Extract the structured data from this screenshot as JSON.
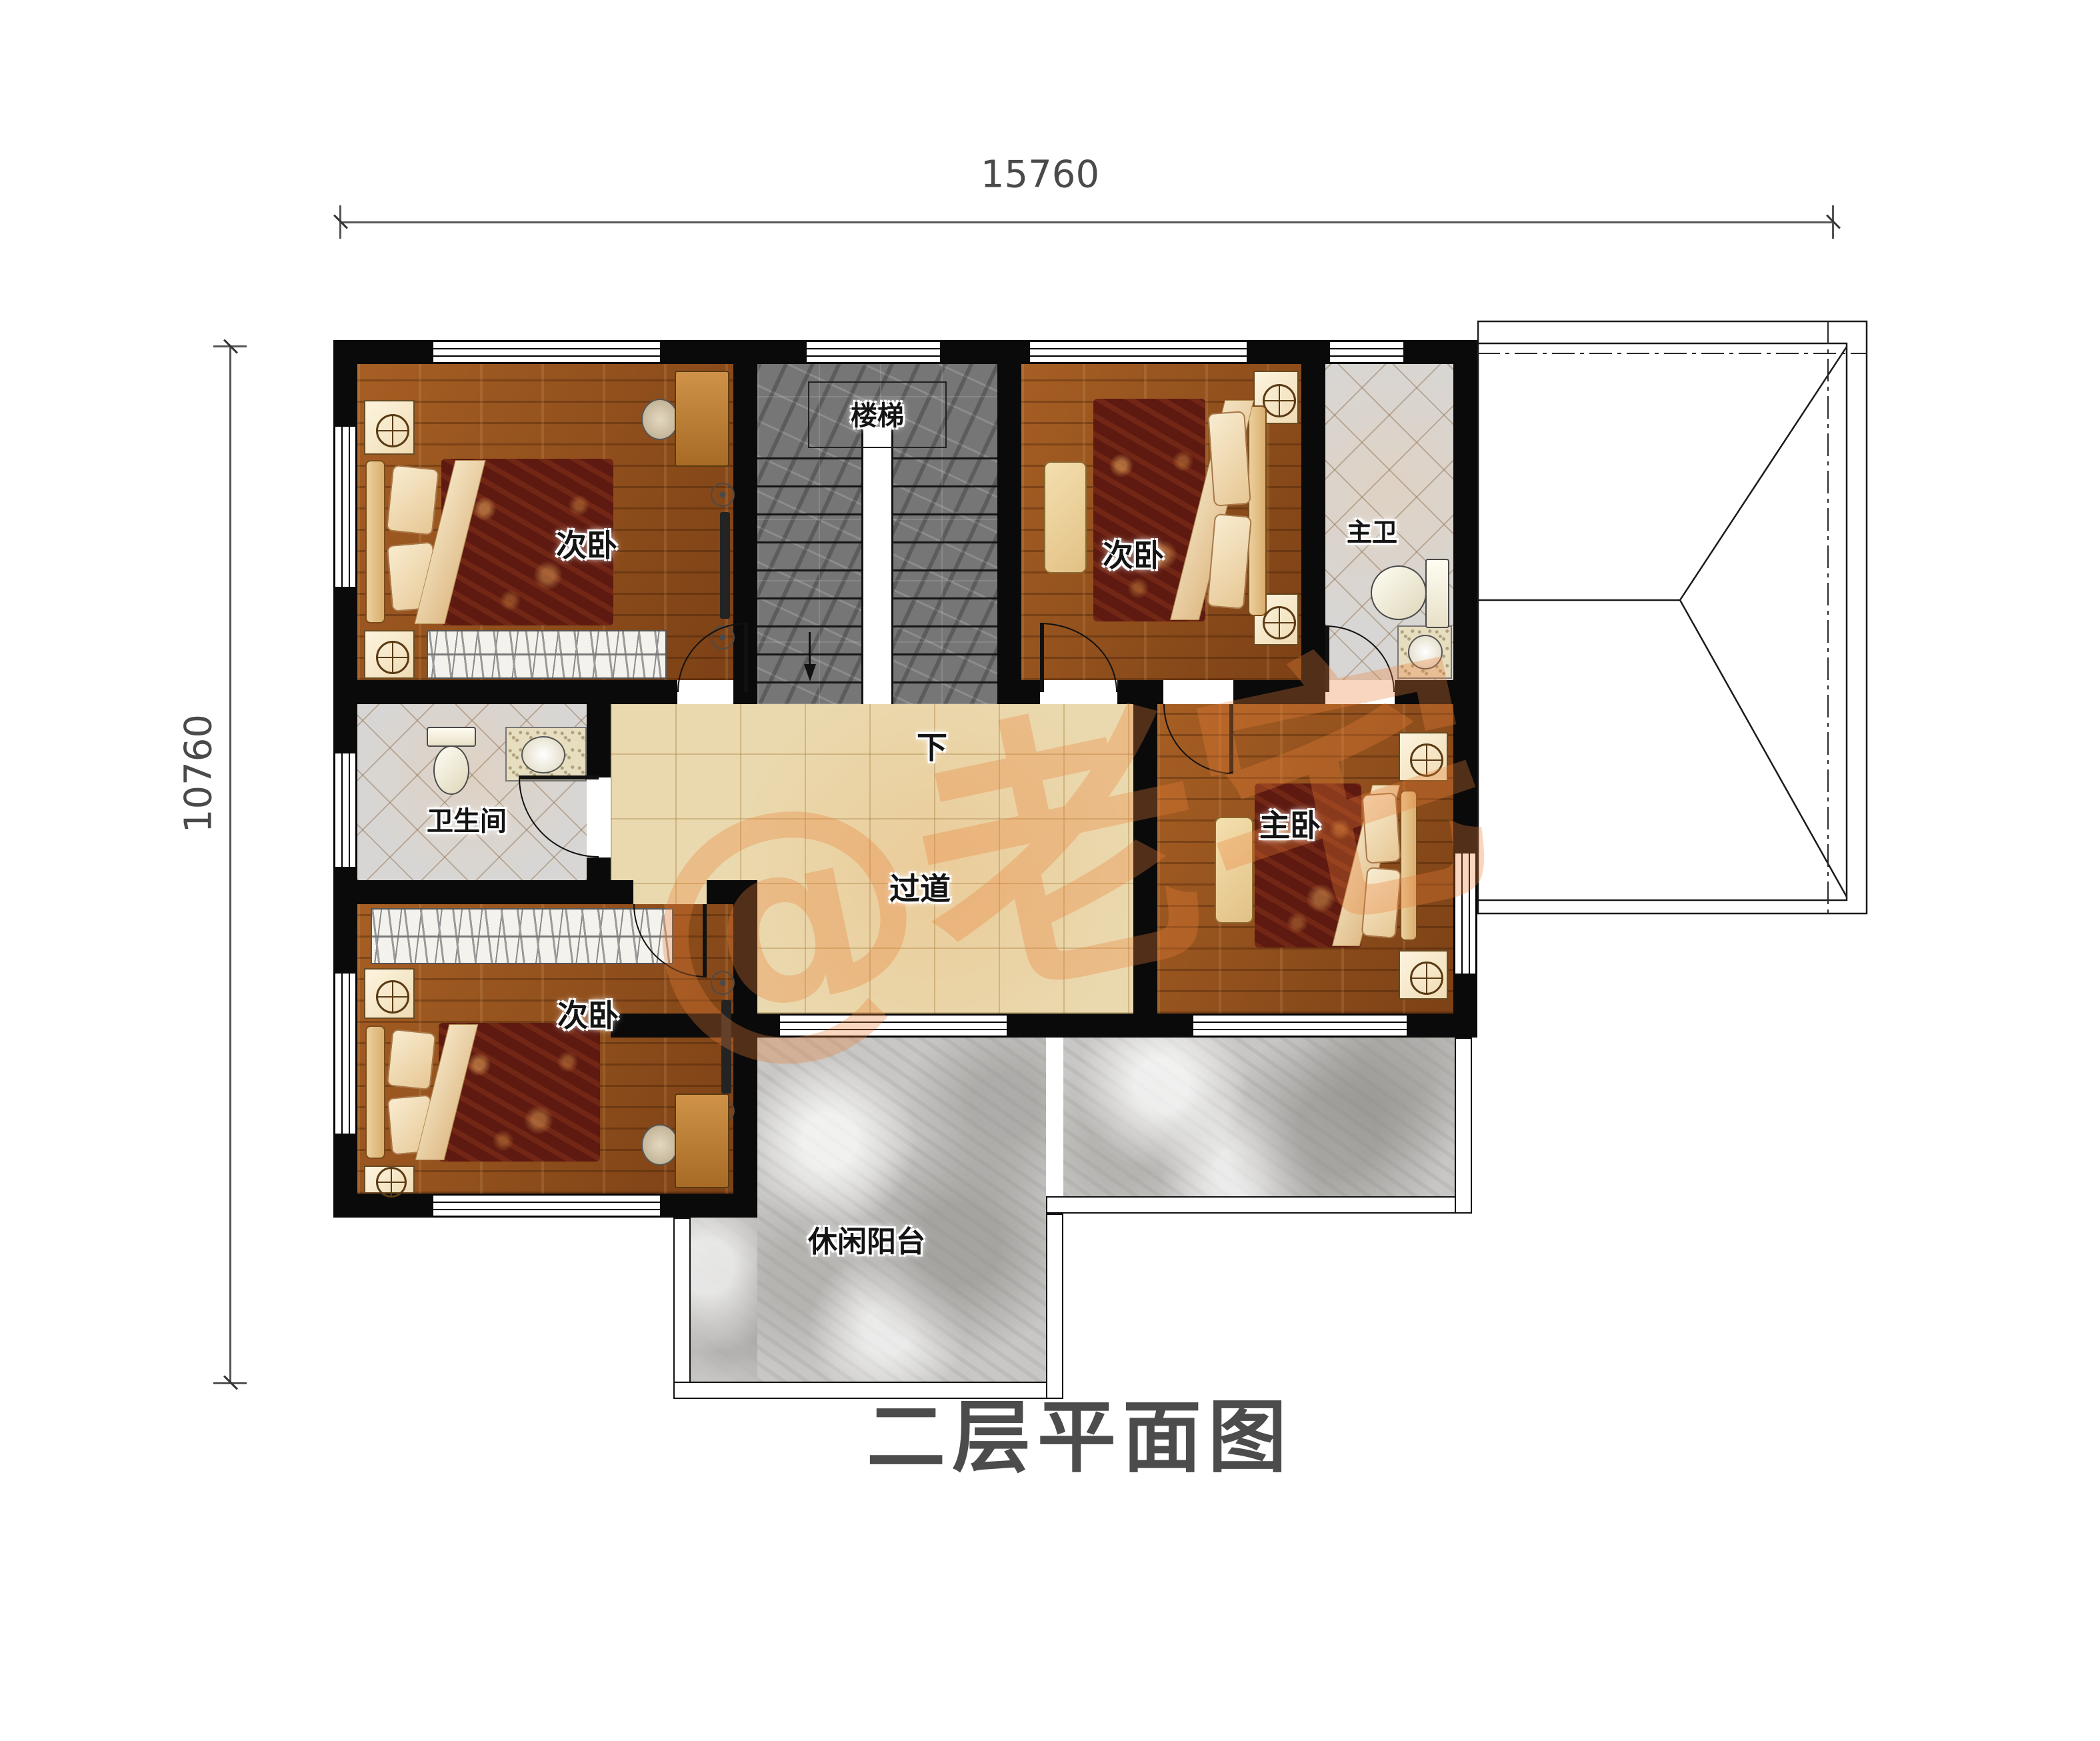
{
  "title": {
    "text": "二层平面图"
  },
  "dimensions": {
    "top": "15760",
    "left": "10760"
  },
  "watermark": {
    "text": "@老宅"
  },
  "rooms": {
    "bedroom_tl": {
      "label": "次卧"
    },
    "stairwell": {
      "label": "楼梯",
      "down_label": "下"
    },
    "bedroom_tm": {
      "label": "次卧"
    },
    "master_bath": {
      "label": "主卫"
    },
    "bathroom": {
      "label": "卫生间"
    },
    "corridor": {
      "label": "过道"
    },
    "master_bedroom": {
      "label": "主卧"
    },
    "bedroom_bl": {
      "label": "次卧"
    },
    "balcony": {
      "label": "休闲阳台"
    }
  },
  "colors": {
    "wall": "#0a0a0a",
    "wood_floor": "#93521f",
    "marble_floor": "#767676",
    "diamond_tile": "#d8d6d4",
    "beige_tile": "#ead9ae",
    "concrete": "#c8c7c5",
    "watermark": "rgba(233,126,56,0.32)",
    "dim_text": "#4a4a4a",
    "title_text": "#4c4c4c"
  }
}
